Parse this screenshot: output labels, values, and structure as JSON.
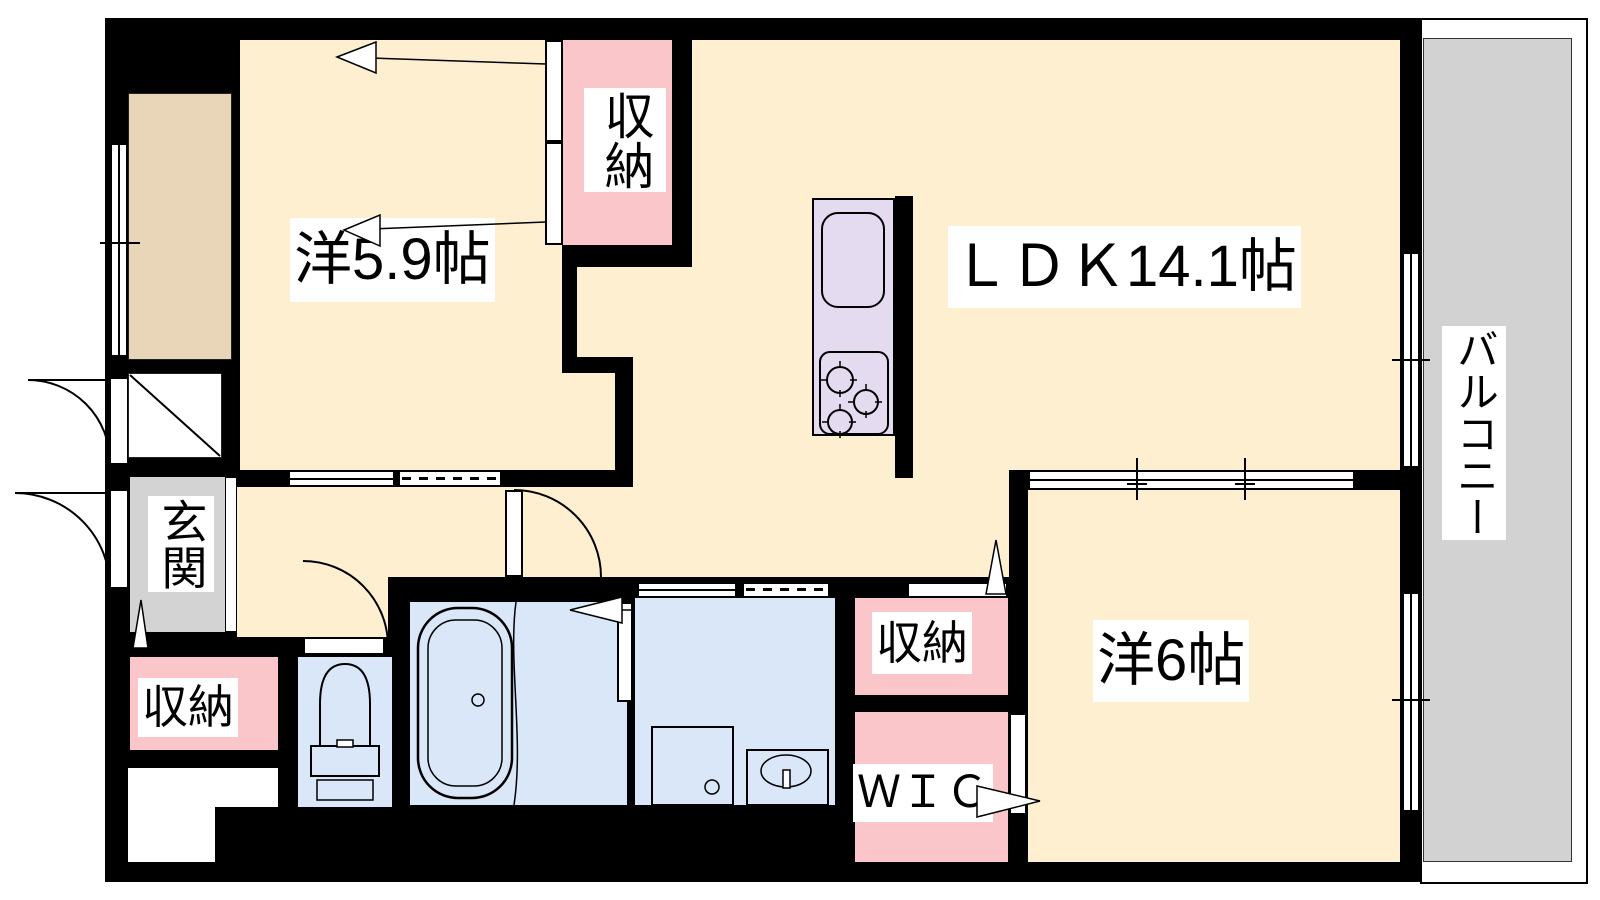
{
  "title": "2LDK apartment floor plan",
  "rooms": {
    "western_room_1": {
      "label": "洋5.9帖",
      "type": "bedroom"
    },
    "ldk": {
      "label": "ＬＤＫ14.1帖",
      "type": "living-dining-kitchen"
    },
    "western_room_2": {
      "label": "洋6帖",
      "type": "bedroom"
    },
    "balcony": {
      "label": "バルコニー",
      "type": "balcony"
    },
    "entrance": {
      "label": "玄関",
      "type": "entrance"
    },
    "storage_top": {
      "label": "収納",
      "type": "closet"
    },
    "storage_left": {
      "label": "収納",
      "type": "closet"
    },
    "storage_mid": {
      "label": "収納",
      "type": "closet"
    },
    "wic": {
      "label": "ＷＩＣ",
      "type": "walk-in-closet"
    }
  },
  "fixtures": [
    "bathtub",
    "toilet",
    "washbasin",
    "washing-machine-pan",
    "kitchen-sink",
    "stove-burners"
  ],
  "colors": {
    "beige": "#fdefd0",
    "tan": "#e9d6b9",
    "pink": "#fbc6ca",
    "blue": "#d9e7f8",
    "purple": "#e4dbf1",
    "gray_entrance": "#d3d3d3",
    "gray_balcony": "#d2d2d2",
    "wall": "#000000"
  }
}
